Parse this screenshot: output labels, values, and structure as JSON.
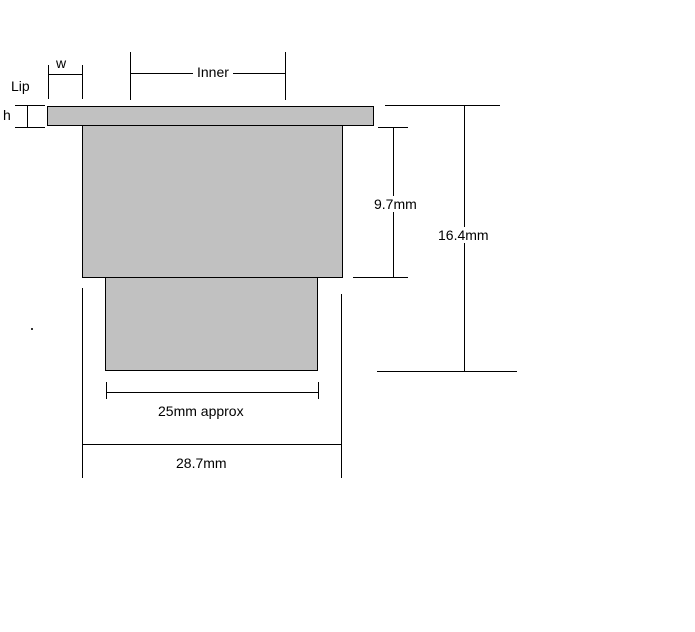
{
  "diagram": {
    "type": "technical-cross-section",
    "colors": {
      "background": "#ffffff",
      "shape_fill": "#c1c1c1",
      "line": "#000000",
      "text": "#000000"
    },
    "labels": {
      "w": "w",
      "lip": "Lip",
      "h": "h",
      "inner": "Inner",
      "inner_depth": "9.7mm",
      "total_depth": "16.4mm",
      "lower_width": "25mm approx",
      "body_width": "28.7mm"
    },
    "parts": {
      "flange": "top lip flange",
      "body": "main body",
      "lower_block": "lower inner block"
    }
  }
}
